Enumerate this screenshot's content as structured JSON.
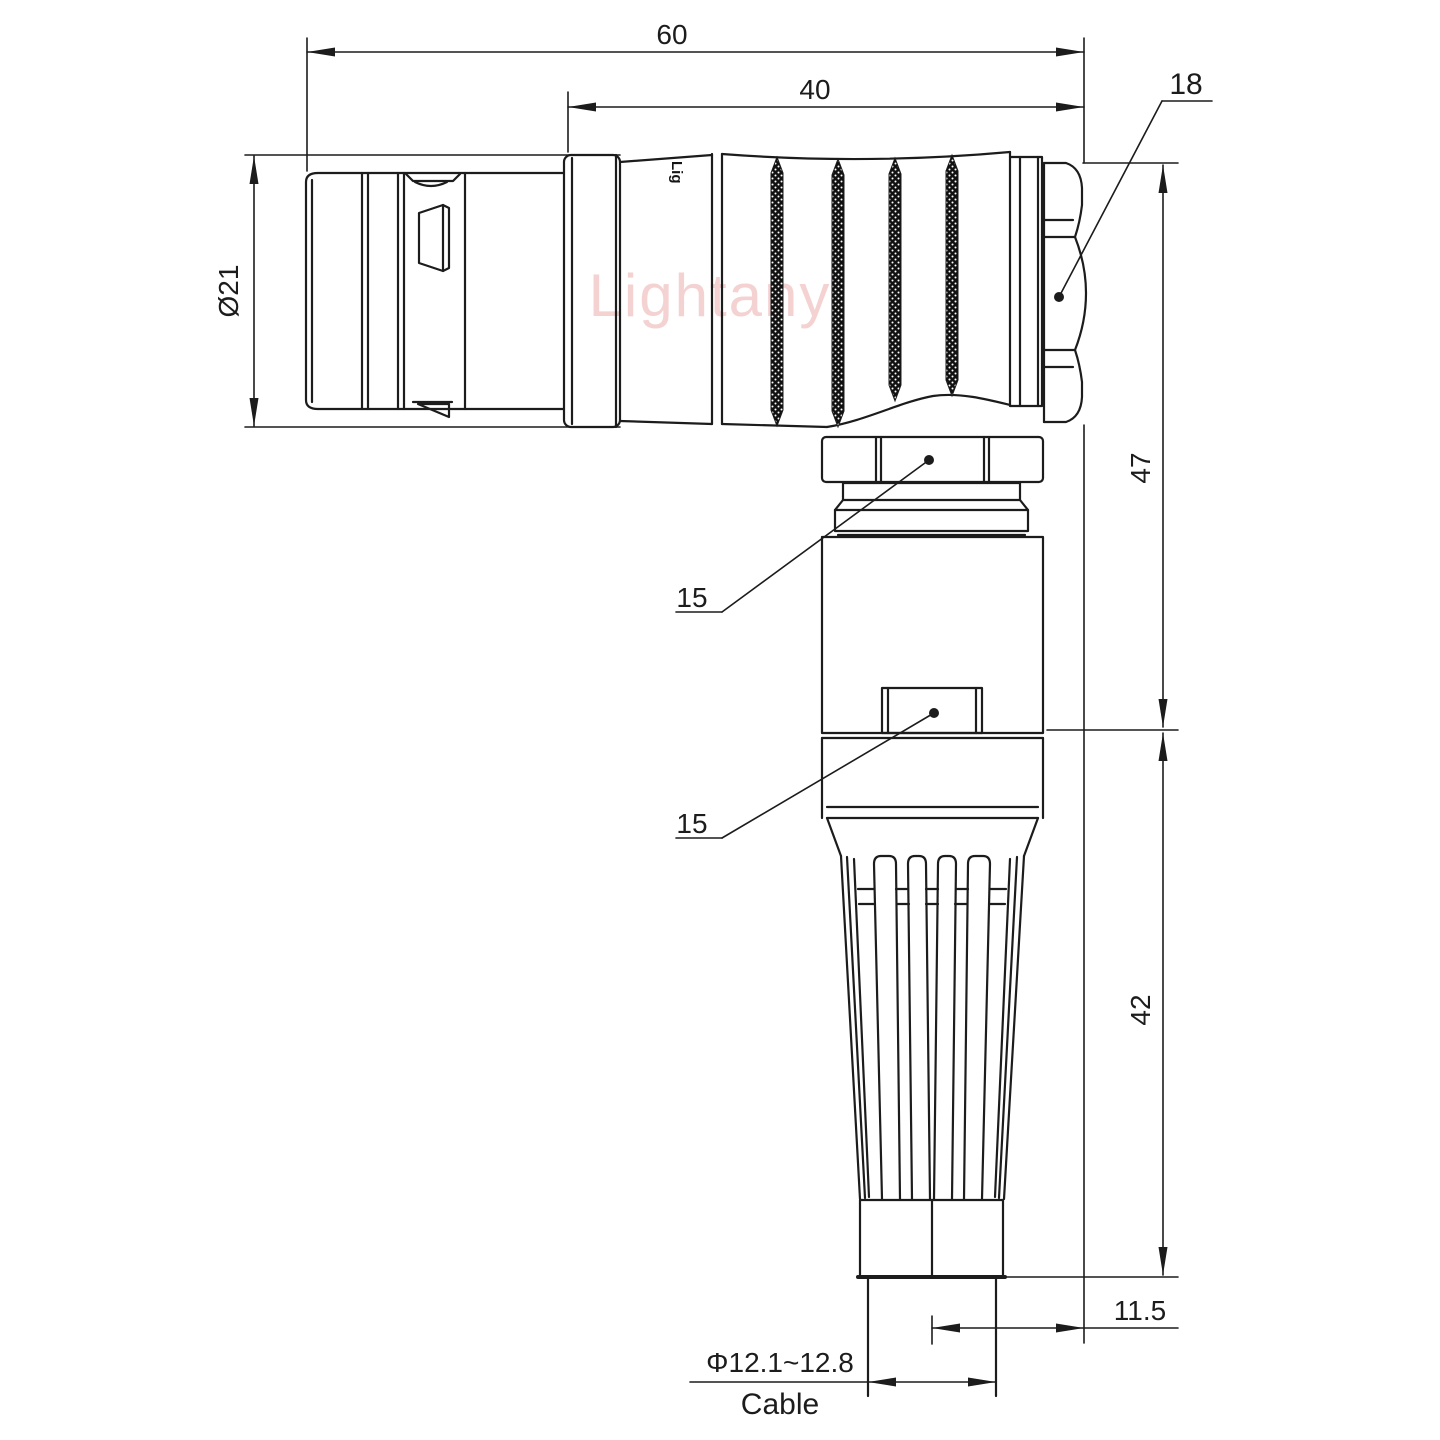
{
  "drawing": {
    "watermark_text": "Lightany",
    "brand_engraving": "Lig",
    "dims": {
      "overall_length": "60",
      "rear_length": "40",
      "backnut_label": "18",
      "front_diameter": "Ø21",
      "upper_height": "47",
      "lower_height": "42",
      "axis_offset": "11.5",
      "coupling_nut_label": "15",
      "housing_label": "15",
      "cable_diameter": "Φ12.1~12.8",
      "cable_word": "Cable"
    },
    "colors": {
      "line": "#1c1c1c",
      "watermark": "#f3cbcb",
      "background": "#ffffff"
    }
  }
}
